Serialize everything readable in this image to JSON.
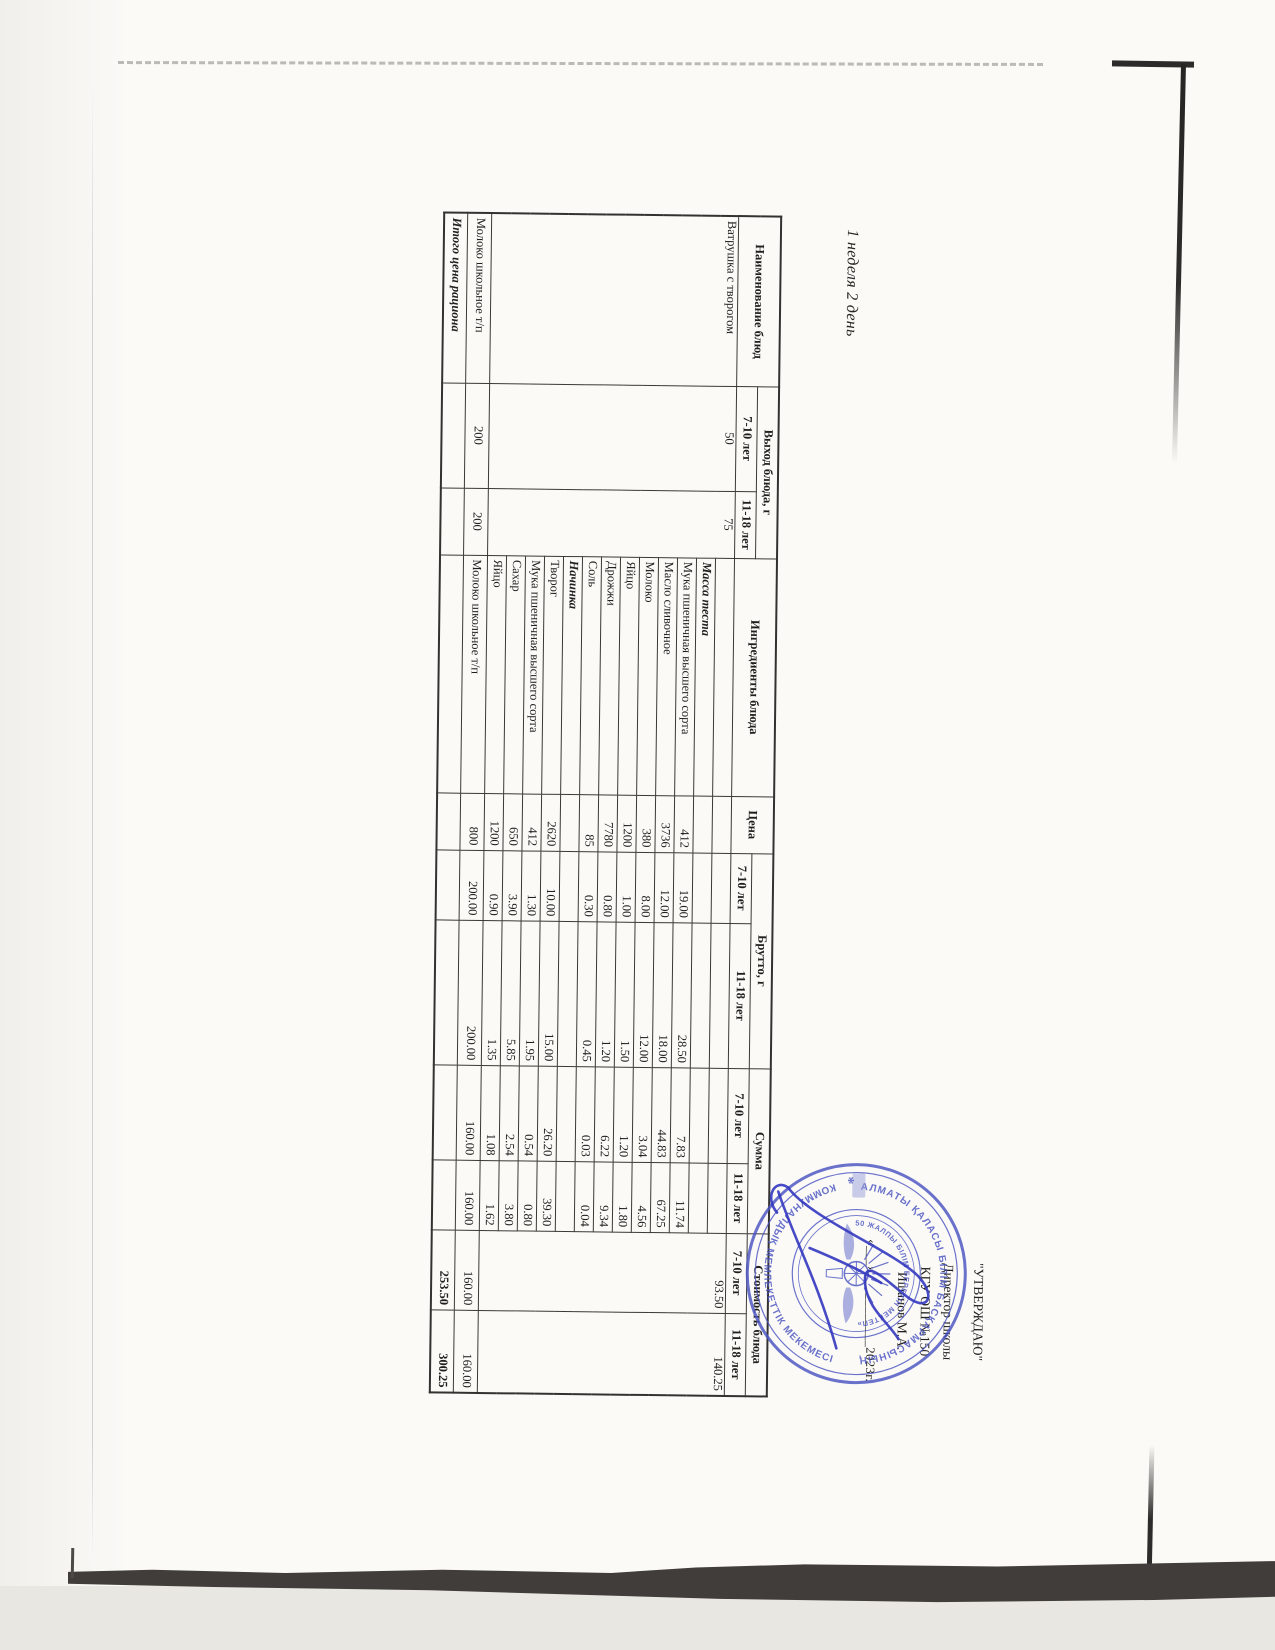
{
  "page": {
    "title": "1 неделя 2 день"
  },
  "table": {
    "headers": {
      "dish": "Наименование блюд",
      "output": "Выход блюда, г",
      "ingredients": "Ингредиенты блюда",
      "price": "Цена",
      "gross": "Брутто, г",
      "sum": "Сумма",
      "cost": "Стоимость блюда",
      "age_7_10": "7-10 лет",
      "age_11_18": "11-18 лет"
    },
    "dish_row": {
      "name": "Ватрушка с творогом",
      "output_7_10": "50",
      "output_11_18": "75",
      "cost_7_10": "93.50",
      "cost_11_18": "140.25"
    },
    "ingredient_rows": [
      {
        "name": "Масса теста",
        "section": true,
        "price": "",
        "gross_7_10": "",
        "gross_11_18": "",
        "sum_7_10": "",
        "sum_11_18": ""
      },
      {
        "name": "Мука пшеничная высшего сорта",
        "price": "412",
        "gross_7_10": "19.00",
        "gross_11_18": "28.50",
        "sum_7_10": "7.83",
        "sum_11_18": "11.74"
      },
      {
        "name": "Масло сливочное",
        "price": "3736",
        "gross_7_10": "12.00",
        "gross_11_18": "18.00",
        "sum_7_10": "44.83",
        "sum_11_18": "67.25"
      },
      {
        "name": "Молоко",
        "price": "380",
        "gross_7_10": "8.00",
        "gross_11_18": "12.00",
        "sum_7_10": "3.04",
        "sum_11_18": "4.56"
      },
      {
        "name": "Яйцо",
        "price": "1200",
        "gross_7_10": "1.00",
        "gross_11_18": "1.50",
        "sum_7_10": "1.20",
        "sum_11_18": "1.80"
      },
      {
        "name": "Дрожжи",
        "price": "7780",
        "gross_7_10": "0.80",
        "gross_11_18": "1.20",
        "sum_7_10": "6.22",
        "sum_11_18": "9.34"
      },
      {
        "name": "Соль",
        "price": "85",
        "gross_7_10": "0.30",
        "gross_11_18": "0.45",
        "sum_7_10": "0.03",
        "sum_11_18": "0.04"
      },
      {
        "name": "Начинка",
        "section": true,
        "price": "",
        "gross_7_10": "",
        "gross_11_18": "",
        "sum_7_10": "",
        "sum_11_18": ""
      },
      {
        "name": "Творог",
        "price": "2620",
        "gross_7_10": "10.00",
        "gross_11_18": "15.00",
        "sum_7_10": "26.20",
        "sum_11_18": "39.30"
      },
      {
        "name": "Мука пшеничная высшего сорта",
        "price": "412",
        "gross_7_10": "1.30",
        "gross_11_18": "1.95",
        "sum_7_10": "0.54",
        "sum_11_18": "0.80"
      },
      {
        "name": "Сахар",
        "price": "650",
        "gross_7_10": "3.90",
        "gross_11_18": "5.85",
        "sum_7_10": "2.54",
        "sum_11_18": "3.80"
      },
      {
        "name": "Яйцо",
        "price": "1200",
        "gross_7_10": "0.90",
        "gross_11_18": "1.35",
        "sum_7_10": "1.08",
        "sum_11_18": "1.62"
      }
    ],
    "milk_row": {
      "name": "Молоко школьное т/п",
      "output_7_10": "200",
      "output_11_18": "200",
      "ingredient": "Молоко школьное т/п",
      "price": "800",
      "gross_7_10": "200.00",
      "gross_11_18": "200.00",
      "sum_7_10": "160.00",
      "sum_11_18": "160.00",
      "cost_7_10": "160.00",
      "cost_11_18": "160.00"
    },
    "total_row": {
      "label": "Итого цена рациона",
      "cost_7_10": "253.50",
      "cost_11_18": "300.25"
    }
  },
  "approval": {
    "line1": "\"УТВЕРЖДАЮ\"",
    "line2": "Директор школы",
    "line3": "КГУ ОШ №150",
    "line4": "Ишанов М.А.",
    "date_line": "«___»___________2023г."
  },
  "stamp": {
    "ring_text_outer_top": "АЛМАТЫ ҚАЛАСЫ БІЛІМ БАСҚАРМАСЫНЫҢ",
    "ring_text_outer_bottom": "КОММУНАЛДЫҚ МЕМЛЕКЕТТІК МЕКЕМЕСІ",
    "ring_text_inner": "«№150 ЖАЛПЫ БІЛІМ БЕРЕТІН МЕКТЕП» КММ",
    "color": "#4a54c2"
  }
}
